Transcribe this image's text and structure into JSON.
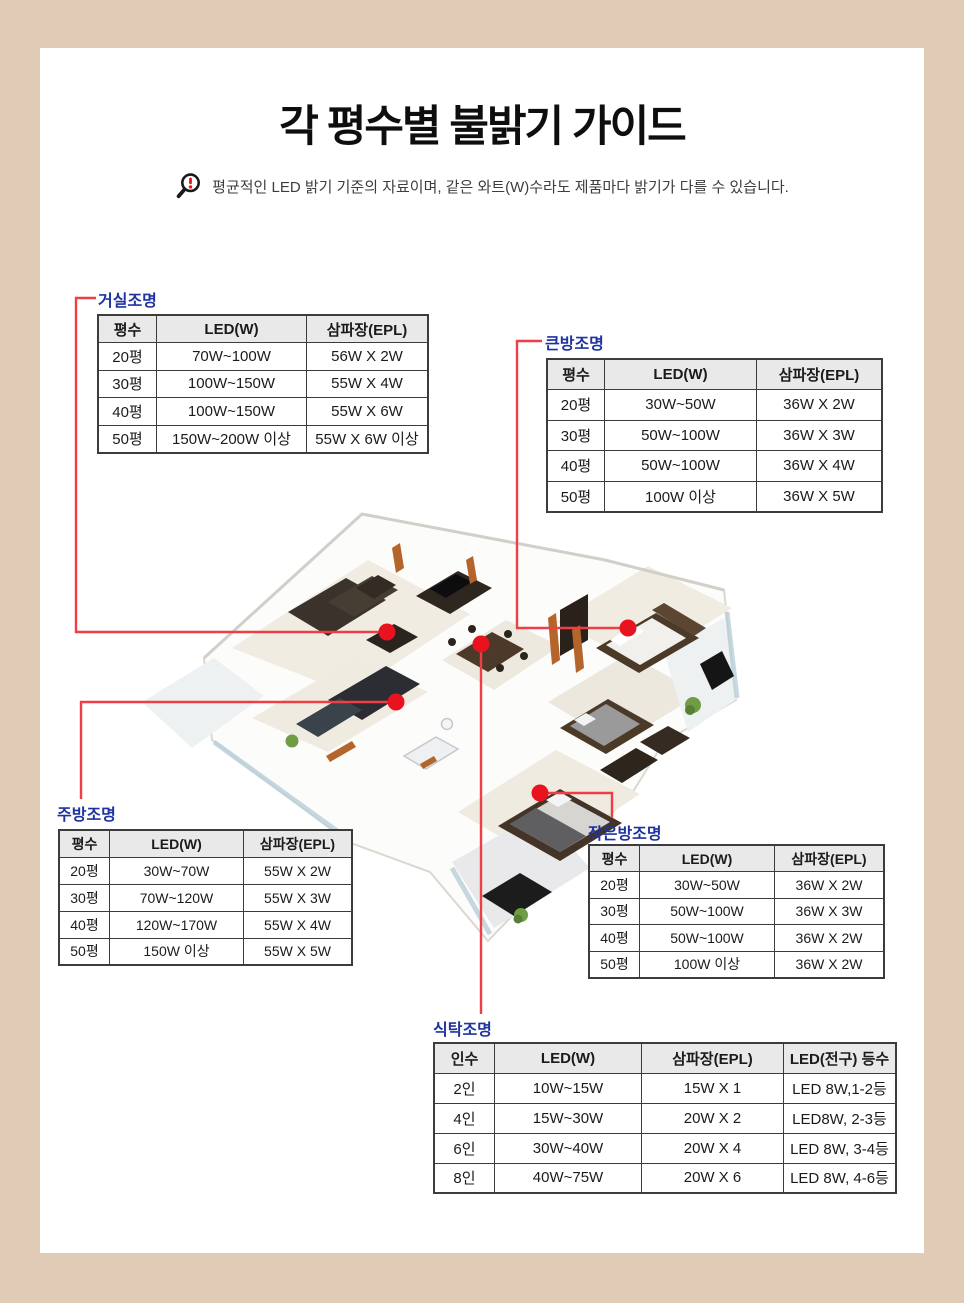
{
  "page": {
    "title": "각 평수별 불밝기 가이드",
    "notice": {
      "icon": "magnifier-exclamation-icon",
      "text": "평균적인 LED 밝기 기준의 자료이며, 같은 와트(W)수라도 제품마다 밝기가 다를 수 있습니다."
    }
  },
  "colors": {
    "background_beige": "#e0cbb6",
    "content_white": "#ffffff",
    "label_blue": "#1e33a0",
    "leader_line_red": "#ee3f45",
    "leader_dot_red": "#e8131f",
    "table_header_gray": "#e9e9e9",
    "table_border": "#3c3c3c"
  },
  "tables": {
    "living": {
      "label": "거실조명",
      "headers": [
        "평수",
        "LED(W)",
        "삼파장(EPL)"
      ],
      "rows": [
        [
          "20평",
          "70W~100W",
          "56W X 2W"
        ],
        [
          "30평",
          "100W~150W",
          "55W X 4W"
        ],
        [
          "40평",
          "100W~150W",
          "55W X 6W"
        ],
        [
          "50평",
          "150W~200W 이상",
          "55W X 6W 이상"
        ]
      ]
    },
    "bigroom": {
      "label": "큰방조명",
      "headers": [
        "평수",
        "LED(W)",
        "삼파장(EPL)"
      ],
      "rows": [
        [
          "20평",
          "30W~50W",
          "36W X 2W"
        ],
        [
          "30평",
          "50W~100W",
          "36W X 3W"
        ],
        [
          "40평",
          "50W~100W",
          "36W X 4W"
        ],
        [
          "50평",
          "100W 이상",
          "36W X 5W"
        ]
      ]
    },
    "kitchen": {
      "label": "주방조명",
      "headers": [
        "평수",
        "LED(W)",
        "삼파장(EPL)"
      ],
      "rows": [
        [
          "20평",
          "30W~70W",
          "55W X 2W"
        ],
        [
          "30평",
          "70W~120W",
          "55W X 3W"
        ],
        [
          "40평",
          "120W~170W",
          "55W X 4W"
        ],
        [
          "50평",
          "150W 이상",
          "55W X 5W"
        ]
      ]
    },
    "smallroom": {
      "label": "작은방조명",
      "headers": [
        "평수",
        "LED(W)",
        "삼파장(EPL)"
      ],
      "rows": [
        [
          "20평",
          "30W~50W",
          "36W X 2W"
        ],
        [
          "30평",
          "50W~100W",
          "36W X 3W"
        ],
        [
          "40평",
          "50W~100W",
          "36W X 2W"
        ],
        [
          "50평",
          "100W 이상",
          "36W X 2W"
        ]
      ]
    },
    "dining": {
      "label": "식탁조명",
      "headers": [
        "인수",
        "LED(W)",
        "삼파장(EPL)",
        "LED(전구) 등수"
      ],
      "rows": [
        [
          "2인",
          "10W~15W",
          "15W X 1",
          "LED 8W,1-2등"
        ],
        [
          "4인",
          "15W~30W",
          "20W X 2",
          "LED8W, 2-3등"
        ],
        [
          "6인",
          "30W~40W",
          "20W X 4",
          "LED 8W, 3-4등"
        ],
        [
          "8인",
          "40W~75W",
          "20W X 6",
          "LED 8W, 4-6등"
        ]
      ]
    }
  }
}
